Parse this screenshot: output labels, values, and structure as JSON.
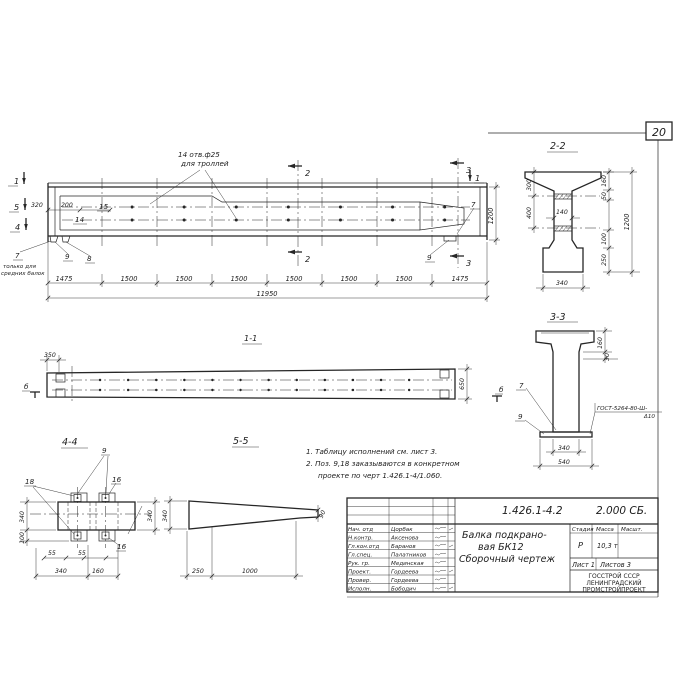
{
  "page": {
    "sheet_number": "20"
  },
  "main_view": {
    "callout_line1": "14 отв.ф25",
    "callout_line2": "для троллей",
    "dim_320": "320",
    "dim_200": "200",
    "poz_15": "15",
    "poz_14": "14",
    "marks": {
      "m1_left": "1",
      "m5_left": "5",
      "m4_left": "4",
      "m1_right": "1",
      "m2_top": "2",
      "m2_bottom": "2",
      "m3_top": "3",
      "m3_bottom": "3"
    },
    "poz_7_left": "7",
    "poz_7_right": "7",
    "poz_8": "8",
    "poz_9_left": "9",
    "poz_9_right": "9",
    "note_line1": "только для",
    "note_line2": "средних балок",
    "segments": [
      "1475",
      "1500",
      "1500",
      "1500",
      "1500",
      "1500",
      "1500",
      "1475"
    ],
    "dim_total": "11950",
    "dim_height": "1200"
  },
  "section_1_1": {
    "title": "1-1",
    "dim_350": "350",
    "dim_650": "650",
    "mark_left": "б",
    "mark_right": "б"
  },
  "section_2_2": {
    "title": "2-2",
    "dim_300": "300",
    "dim_400": "400",
    "dim_140": "140",
    "dim_160": "160",
    "dim_50": "50",
    "dim_100": "100",
    "dim_250": "250",
    "dim_1200": "1200",
    "dim_340": "340"
  },
  "section_3_3": {
    "title": "3-3",
    "dim_160": "160",
    "dim_30": "30",
    "dim_340": "340",
    "dim_540": "540",
    "poz_7": "7",
    "poz_9": "9",
    "weld_line1": "ГОСТ-5264-80-Ш-",
    "weld_line2": "Δ10"
  },
  "section_4_4": {
    "title": "4-4",
    "poz_9": "9",
    "poz_18": "18",
    "poz_16_top": "16",
    "poz_16_bottom": "16",
    "dim_55_a": "55",
    "dim_55_b": "55",
    "dim_340_bottom": "340",
    "dim_160": "160",
    "dim_340_left": "340",
    "dim_100": "100",
    "dim_340_right": "340"
  },
  "section_5_5": {
    "title": "5-5",
    "dim_340": "340",
    "dim_250": "250",
    "dim_1000": "1000",
    "dim_90": "90"
  },
  "notes": {
    "line1": "1. Таблицу исполнений см. лист 3.",
    "line2": "2. Поз. 9,18 заказываются в конкретном",
    "line3": "проекте по черт 1.426.1-4/1.060."
  },
  "title_block": {
    "doc_number": "1.426.1-4.2",
    "doc_code": "2.000 СБ.",
    "title_line1": "Балка подкрано-",
    "title_line2": "вая БК12",
    "title_line3": "Сборочный чертеж",
    "stage_label": "Стадия",
    "mass_label": "Масса",
    "scale_label": "Масшт.",
    "stage_value": "Р",
    "mass_value": "10,3 т",
    "sheet_info": "Лист 1",
    "sheets_info": "Листов 3",
    "org_line1": "ГОССТРОЙ СССР",
    "org_line2": "ЛЕНИНГРАДСКИЙ",
    "org_line3": "ПРОМСТРОЙПРОЕКТ",
    "rows": [
      {
        "role": "Нач. отд",
        "name": "Цорбак"
      },
      {
        "role": "Н.контр.",
        "name": "Аксенова"
      },
      {
        "role": "Гл.кон.отд",
        "name": "Баранов"
      },
      {
        "role": "Гл.спец.",
        "name": "Палатников"
      },
      {
        "role": "Рук. гр.",
        "name": "Мединская"
      },
      {
        "role": "Проект.",
        "name": "Гордеева"
      },
      {
        "role": "Провер.",
        "name": "Гордеева"
      },
      {
        "role": "Исполн.",
        "name": "Бободич"
      }
    ]
  }
}
